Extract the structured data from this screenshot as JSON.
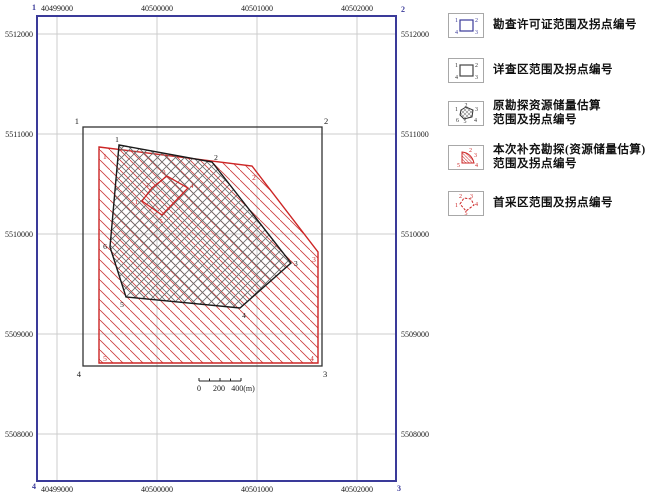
{
  "axes": {
    "x_labels": [
      "40499000",
      "40500000",
      "40501000",
      "40502000"
    ],
    "y_labels": [
      "5512000",
      "5511000",
      "5510000",
      "5509000",
      "5508000"
    ]
  },
  "map": {
    "permit_corner_labels": [
      "1",
      "2",
      "3",
      "4"
    ],
    "survey_corner_labels": [
      "1",
      "2",
      "3",
      "4"
    ],
    "exploration_corner_labels": [
      "1",
      "2",
      "3",
      "4",
      "5",
      "6"
    ],
    "supplement_corner_labels": [
      "1",
      "2",
      "3",
      "4",
      "5"
    ],
    "first_mining_corner_labels": [
      "1",
      "2",
      "3",
      "4",
      "5"
    ],
    "scale_bar_labels": [
      "0",
      "200",
      "400(m)"
    ]
  },
  "legend": {
    "items": [
      {
        "lines": [
          "勘查许可证范围及拐点编号"
        ],
        "corner_labels": [
          "1",
          "2",
          "3",
          "4"
        ]
      },
      {
        "lines": [
          "详查区范围及拐点编号"
        ],
        "corner_labels": [
          "1",
          "2",
          "3",
          "4"
        ]
      },
      {
        "lines": [
          "原勘探资源储量估算",
          "范围及拐点编号"
        ],
        "corner_labels": [
          "1",
          "2",
          "3",
          "4",
          "5",
          "6"
        ]
      },
      {
        "lines": [
          "本次补充勘探(资源储量估算)",
          "范围及拐点编号"
        ],
        "corner_labels": [
          "2",
          "3",
          "4",
          "5"
        ]
      },
      {
        "lines": [
          "首采区范围及拐点编号"
        ],
        "corner_labels": [
          "1",
          "2",
          "3",
          "4",
          "5"
        ]
      }
    ]
  },
  "colors": {
    "frame_blue": "#3a3a99",
    "boundary_red": "#cc2525",
    "red_hatch": "#cc3a3a",
    "survey_black": "#333333",
    "exploration_black": "#1a1a1a",
    "hatch_gray": "#6b6b6b",
    "grid_gray": "#cccccc"
  }
}
